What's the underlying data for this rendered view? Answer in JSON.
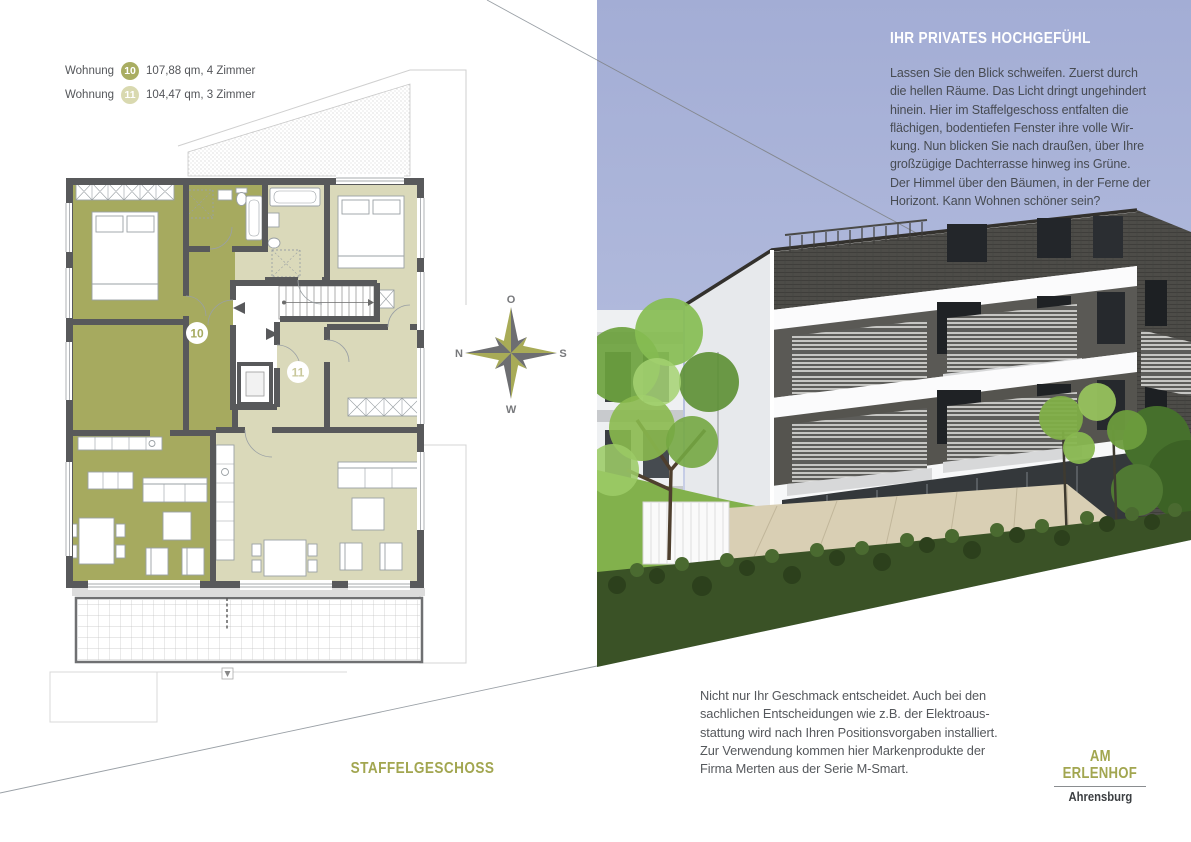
{
  "legend": {
    "rows": [
      {
        "label": "Wohnung",
        "number": "10",
        "details": "107,88 qm, 4 Zimmer"
      },
      {
        "label": "Wohnung",
        "number": "11",
        "details": "104,47 qm, 3 Zimmer"
      }
    ]
  },
  "plan": {
    "caption": "STAFFELGESCHOSS",
    "badge10": "10",
    "badge11": "11"
  },
  "compass": {
    "north": "N",
    "east": "O",
    "south": "S",
    "west": "W"
  },
  "hero": {
    "headline": "IHR PRIVATES HOCHGEFÜHL",
    "lines": [
      "Lassen Sie den Blick schweifen. Zuerst durch",
      "die hellen Räume. Das Licht dringt ungehindert",
      "hinein. Hier im Staffelgeschoss entfalten die",
      "flächigen, bodentiefen Fenster ihre volle Wir-",
      "kung. Nun blicken Sie nach draußen, über Ihre",
      "großzügige Dachterrasse hinweg ins Grüne.",
      "Der Himmel über den Bäumen, in der Ferne der",
      "Horizont. Kann Wohnen schöner sein?"
    ]
  },
  "footer": {
    "lines": [
      "Nicht nur Ihr Geschmack entscheidet. Auch bei den",
      "sachlichen Entscheidungen wie z.B. der Elektroaus-",
      "stattung wird nach Ihren Positionsvorgaben installiert.",
      "Zur Verwendung kommen hier Markenprodukte der",
      "Firma Merten aus der Serie M-Smart."
    ]
  },
  "brand": {
    "line1": "AM",
    "line2": "ERLENHOF",
    "city": "Ahrensburg"
  },
  "colors": {
    "apartment10": "#a6aa5f",
    "apartment11": "#dad9ba",
    "wall": "#58595b",
    "olive_text": "#a2a650",
    "sky": "#a7b0d6"
  }
}
